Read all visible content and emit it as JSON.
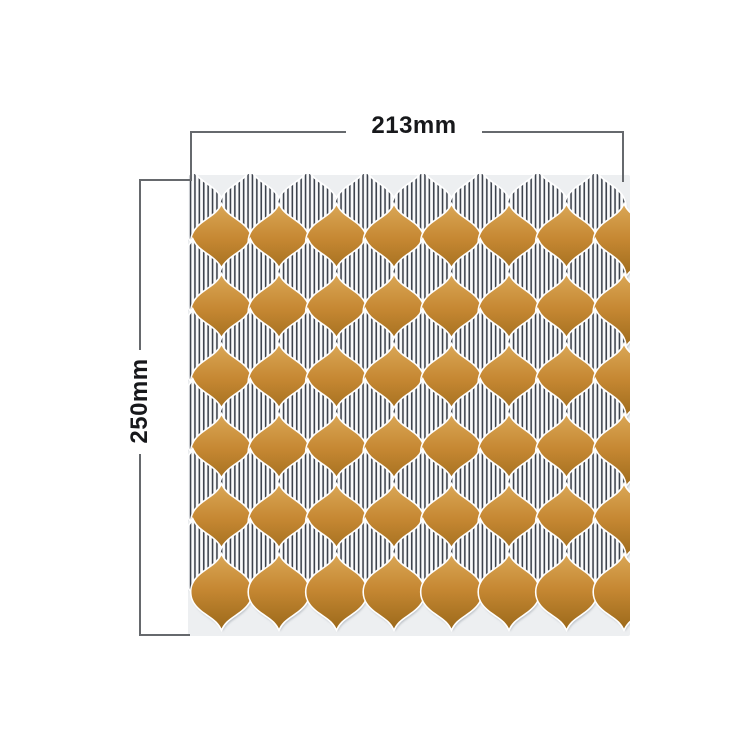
{
  "figure": {
    "type": "product dimension diagram",
    "background_color": "#ffffff"
  },
  "annotations": {
    "width": {
      "label": "213mm"
    },
    "height": {
      "label": "250mm"
    },
    "line_color": "#66696d",
    "label_color": "#17181b"
  },
  "tile_sheet": {
    "description": "Self-adhesive arabesque lantern mosaic tile sheet with alternating rows of caramel-gold tiles and white tiles with dark pinstripes",
    "backing_color": "#edeff1",
    "grout_color": "#ffffff",
    "shadow_color": "#9aa0a8",
    "gold_tile": {
      "highlight": "#d9a655",
      "base": "#c68833",
      "shade": "#9d6a1b"
    },
    "striped_tile": {
      "background": "#fafbfc",
      "stripe_color": "#3c424c",
      "stripe_width": 1.6,
      "stripe_pitch": 4.4
    },
    "layout": {
      "rows": 12,
      "columns": 8,
      "first_row": "striped",
      "row_pitch": 35,
      "column_pitch": 57.5,
      "tile_width": 60,
      "tile_height": 73,
      "striped_offset_x": 4.75,
      "gold_offset_x": 33.5,
      "first_row_y": 33,
      "sheet_width": 442,
      "sheet_height": 462
    }
  }
}
